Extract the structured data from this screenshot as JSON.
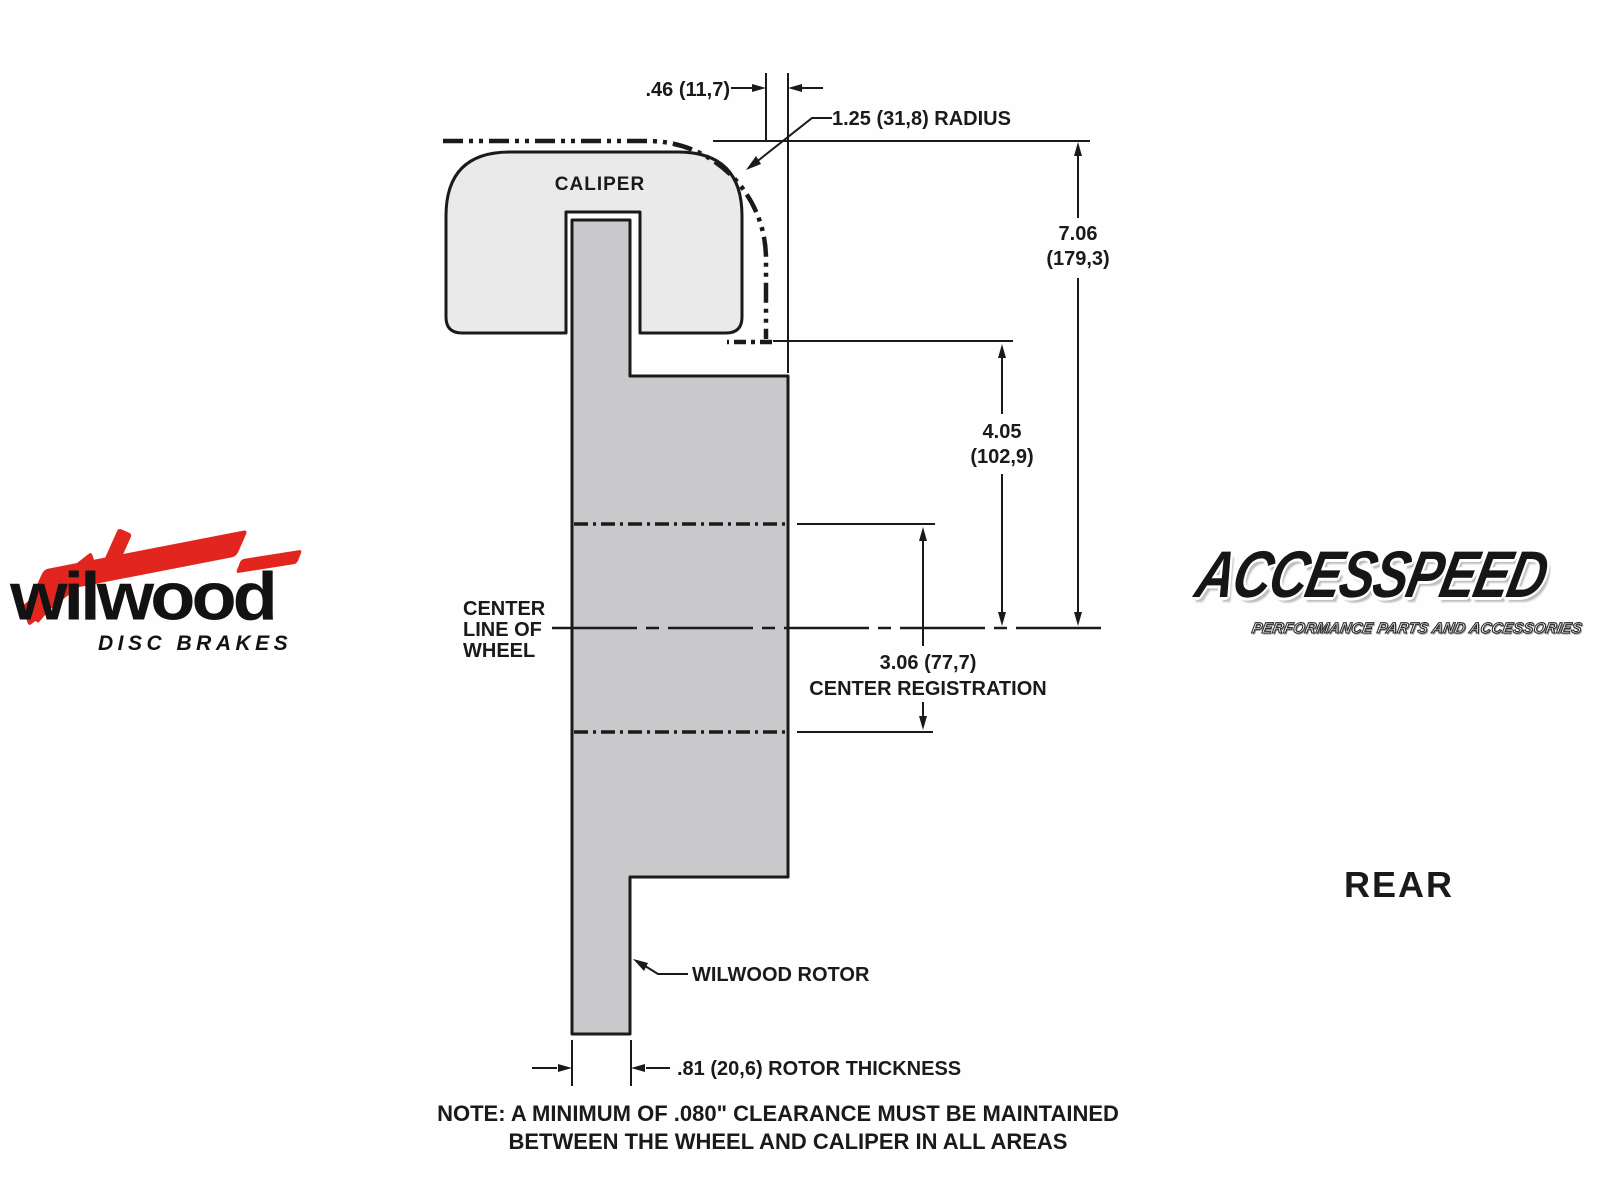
{
  "colors": {
    "line": "#1a1a1a",
    "caliper_fill": "#eaeaea",
    "rotor_fill": "#c9c9cc",
    "wilwood_red": "#e2261f"
  },
  "diagram": {
    "caliper_label": "CALIPER",
    "wheel_centerline": {
      "line1": "CENTER",
      "line2": "LINE OF",
      "line3": "WHEEL"
    },
    "dims": {
      "caliper_offset": ".46 (11,7)",
      "radius": "1.25 (31,8) RADIUS",
      "overall_height_in": "7.06",
      "overall_height_mm": "(179,3)",
      "caliper_height_in": "4.05",
      "caliper_height_mm": "(102,9)",
      "center_registration_value": "3.06 (77,7)",
      "center_registration_label": "CENTER REGISTRATION",
      "rotor_thickness": ".81 (20,6) ROTOR THICKNESS"
    },
    "rotor_label": "WILWOOD ROTOR",
    "note": {
      "line1": "NOTE: A MINIMUM OF .080\" CLEARANCE MUST BE MAINTAINED",
      "line2": "BETWEEN THE WHEEL AND CALIPER IN ALL AREAS"
    },
    "view_label": "REAR"
  },
  "branding": {
    "wilwood": {
      "wordmark": "wilwood",
      "tagline": "DISC BRAKES"
    },
    "accesspeed": {
      "wordmark": "ACCESSPEED",
      "tagline": "PERFORMANCE PARTS AND ACCESSORIES"
    }
  }
}
